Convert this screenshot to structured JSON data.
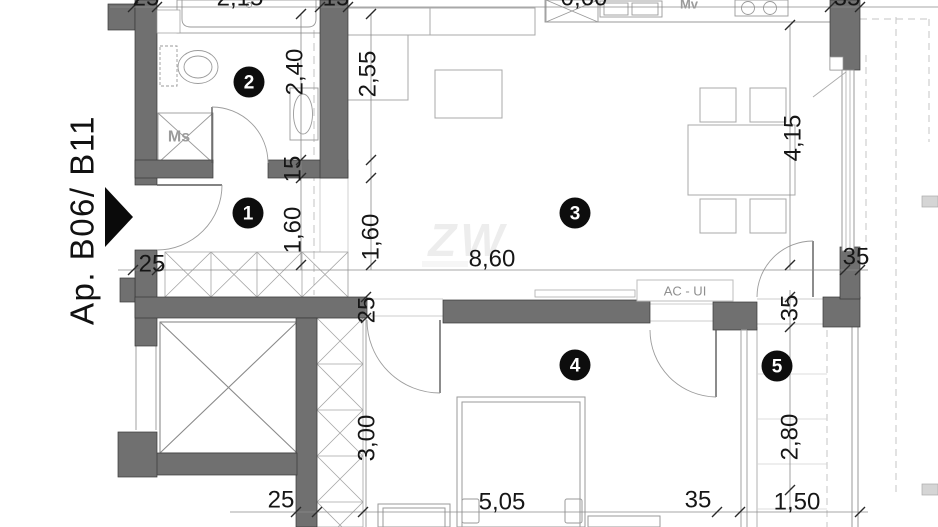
{
  "plan": {
    "apartment_label": "Ap. B06/ B11",
    "watermark_logo": "ZW",
    "rooms": {
      "hall": "1",
      "bathroom": "2",
      "living": "3",
      "bedroom": "4",
      "balcony": "5"
    },
    "equipment": {
      "washing_machine": "Ms",
      "kitchen_appliance": "Mv",
      "ac_unit": "AC - UI"
    },
    "dimensions": {
      "top_wall_25": "25",
      "top_bath_215": "2,15",
      "top_15": "15",
      "top_kitchen_060": "0,60",
      "top_right_35": "35",
      "bath_240": "2,40",
      "living_left_255": "2,55",
      "door_15": "15",
      "hall_160": "1,60",
      "passage_160": "1,60",
      "left_25": "25",
      "total_860": "8,60",
      "right_35": "35",
      "living_right_415": "4,15",
      "closet_25": "25",
      "closet_300": "3,00",
      "balcony_door_35": "35",
      "balcony_280": "2,80",
      "bottom_25": "25",
      "bedroom_505": "5,05",
      "bottom_35": "35",
      "balcony_150": "1,50"
    }
  }
}
